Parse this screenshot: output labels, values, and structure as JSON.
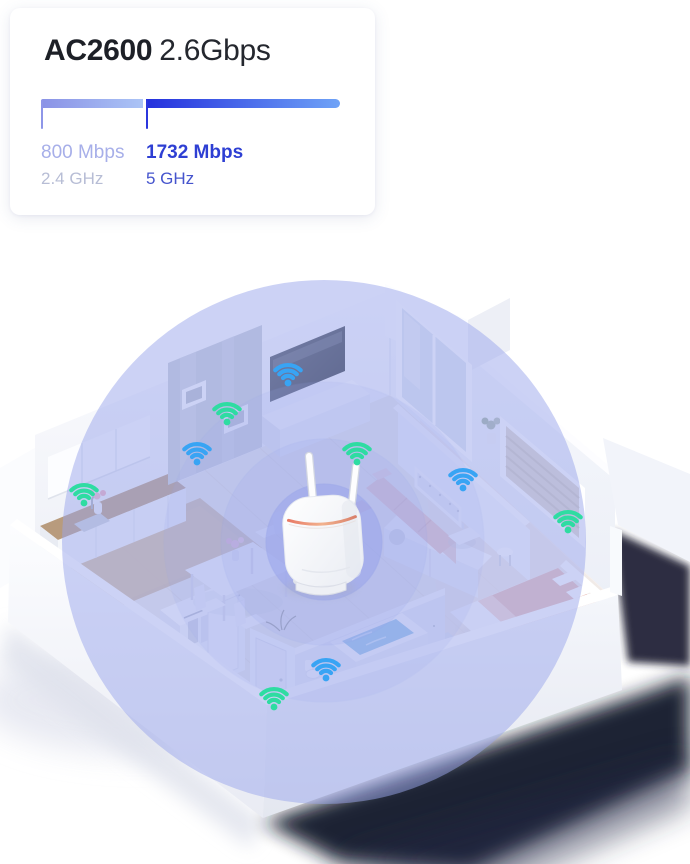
{
  "card": {
    "title": {
      "model": "AC2600",
      "speed": "2.6Gbps"
    },
    "bands": [
      {
        "id": "2g",
        "speed": "800 Mbps",
        "freq": "2.4 GHz",
        "bar_color_start": "#8a92e6",
        "bar_color_end": "#abc4f6",
        "tick_color": "#8e96e8",
        "speed_color": "#a7afe9",
        "freq_color": "#b7bdd5"
      },
      {
        "id": "5g",
        "speed": "1732 Mbps",
        "freq": "5 GHz",
        "bar_color_start": "#2430dd",
        "bar_color_end": "#6fa3f7",
        "tick_color": "#2b36dd",
        "speed_color": "#2e3fd3",
        "freq_color": "#4554cd"
      }
    ]
  },
  "illustration": {
    "coverage_color": "#9aa5ec",
    "band_colors": {
      "green": "#2edca2",
      "blue": "#38a4f4"
    },
    "wifi_icons": [
      {
        "band": "blue",
        "x": 288,
        "y": 153
      },
      {
        "band": "green",
        "x": 227,
        "y": 192
      },
      {
        "band": "blue",
        "x": 197,
        "y": 232
      },
      {
        "band": "green",
        "x": 84,
        "y": 273
      },
      {
        "band": "green",
        "x": 357,
        "y": 232
      },
      {
        "band": "blue",
        "x": 463,
        "y": 258
      },
      {
        "band": "green",
        "x": 568,
        "y": 300
      },
      {
        "band": "blue",
        "x": 326,
        "y": 448
      },
      {
        "band": "green",
        "x": 274,
        "y": 477
      }
    ]
  }
}
